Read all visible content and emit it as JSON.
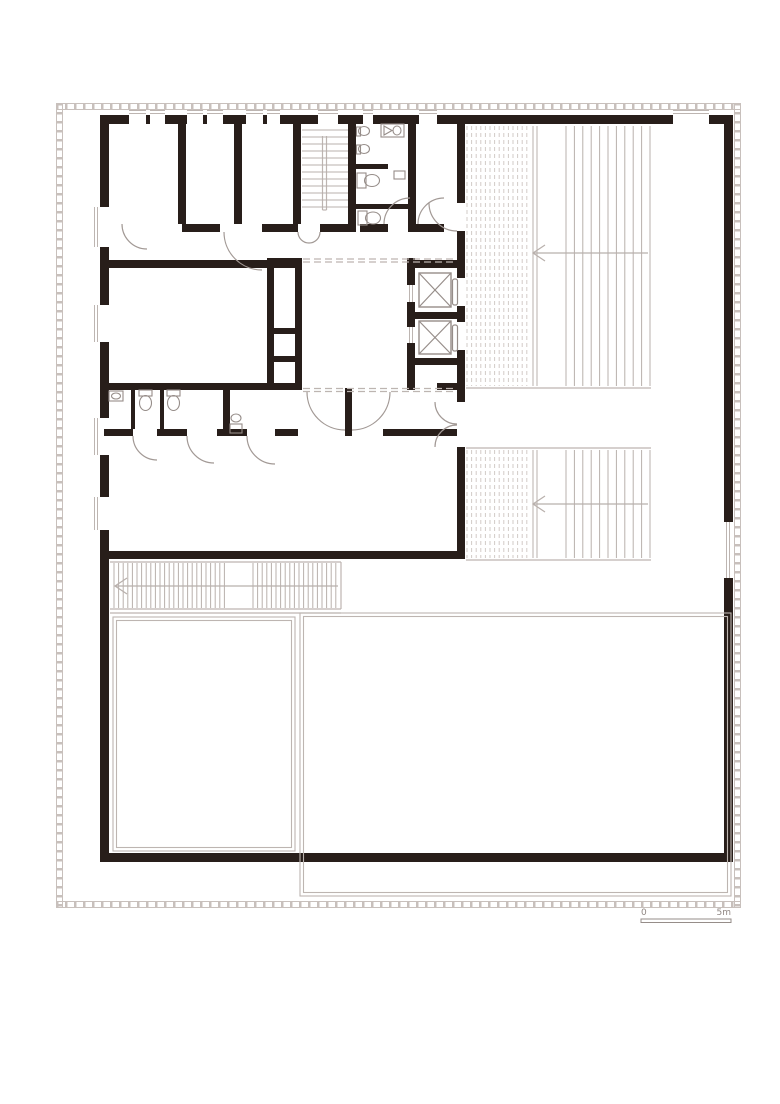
{
  "document": {
    "kind": "architectural floor plan, single storey, black walls on white"
  },
  "scale_bar": {
    "start_label": "0",
    "end_label": "5m"
  },
  "colors": {
    "wall": "#281e1a",
    "line_light": "#bdb5b1",
    "line_mid": "#968d89",
    "door": "#a29995",
    "hatch_dash": "#d2cbc7",
    "hatch_line": "#b8b0ac",
    "frame": "#c8c0bc",
    "label": "#8f8682",
    "background": "#ffffff"
  },
  "plan": {
    "walls": [
      [
        100,
        115,
        29,
        9
      ],
      [
        146,
        115,
        4,
        9
      ],
      [
        165,
        115,
        22,
        9
      ],
      [
        203,
        115,
        4,
        9
      ],
      [
        223,
        115,
        23,
        9
      ],
      [
        263,
        115,
        4,
        9
      ],
      [
        280,
        115,
        38,
        9
      ],
      [
        338,
        115,
        25,
        9
      ],
      [
        373,
        115,
        46,
        9
      ],
      [
        437,
        115,
        236,
        9
      ],
      [
        709,
        115,
        24,
        9
      ],
      [
        100,
        115,
        9,
        92
      ],
      [
        100,
        247,
        9,
        58
      ],
      [
        100,
        342,
        9,
        76
      ],
      [
        100,
        455,
        9,
        42
      ],
      [
        100,
        530,
        9,
        332
      ],
      [
        724,
        115,
        9,
        407
      ],
      [
        724,
        578,
        9,
        284
      ],
      [
        100,
        853,
        633,
        9
      ],
      [
        178,
        124,
        8,
        100
      ],
      [
        234,
        124,
        8,
        100
      ],
      [
        293,
        124,
        8,
        100
      ],
      [
        348,
        124,
        8,
        108
      ],
      [
        408,
        124,
        8,
        108
      ],
      [
        182,
        224,
        38,
        8
      ],
      [
        262,
        224,
        36,
        8
      ],
      [
        320,
        224,
        32,
        8
      ],
      [
        360,
        224,
        28,
        8
      ],
      [
        412,
        224,
        32,
        8
      ],
      [
        109,
        260,
        193,
        8
      ],
      [
        267,
        258,
        7,
        132
      ],
      [
        295,
        258,
        7,
        132
      ],
      [
        274,
        258,
        21,
        7
      ],
      [
        274,
        328,
        21,
        6
      ],
      [
        274,
        356,
        21,
        6
      ],
      [
        274,
        384,
        21,
        6
      ],
      [
        407,
        258,
        8,
        27
      ],
      [
        407,
        302,
        8,
        25
      ],
      [
        407,
        343,
        8,
        47
      ],
      [
        407,
        260,
        58,
        8
      ],
      [
        407,
        312,
        58,
        7
      ],
      [
        407,
        358,
        58,
        7
      ],
      [
        437,
        383,
        28,
        7
      ],
      [
        457,
        124,
        8,
        79
      ],
      [
        457,
        231,
        8,
        47
      ],
      [
        457,
        306,
        8,
        16
      ],
      [
        457,
        350,
        8,
        52
      ],
      [
        457,
        447,
        8,
        106
      ],
      [
        356,
        164,
        32,
        5
      ],
      [
        356,
        204,
        52,
        5
      ],
      [
        104,
        383,
        191,
        7
      ],
      [
        131,
        390,
        4,
        39
      ],
      [
        160,
        390,
        4,
        39
      ],
      [
        223,
        390,
        7,
        39
      ],
      [
        104,
        429,
        29,
        7
      ],
      [
        157,
        429,
        30,
        7
      ],
      [
        217,
        429,
        30,
        7
      ],
      [
        275,
        429,
        23,
        7
      ],
      [
        383,
        429,
        74,
        7
      ],
      [
        345,
        388,
        7,
        48
      ],
      [
        100,
        551,
        365,
        8
      ]
    ],
    "lines": [
      [
        466,
        388,
        651,
        388
      ],
      [
        466,
        448,
        651,
        448
      ],
      [
        466,
        560,
        651,
        560
      ],
      [
        110,
        562,
        341,
        562
      ],
      [
        110,
        609,
        341,
        609
      ],
      [
        341,
        562,
        341,
        609
      ],
      [
        110,
        613,
        341,
        613
      ],
      [
        322.5,
        136,
        322.5,
        210
      ],
      [
        326.5,
        136,
        326.5,
        210
      ],
      [
        322.5,
        210,
        326.5,
        210
      ]
    ],
    "glazing": [
      {
        "o": "h",
        "pos": 112,
        "from": 129,
        "to": 146
      },
      {
        "o": "h",
        "pos": 112,
        "from": 150,
        "to": 165
      },
      {
        "o": "h",
        "pos": 112,
        "from": 187,
        "to": 203
      },
      {
        "o": "h",
        "pos": 112,
        "from": 207,
        "to": 223
      },
      {
        "o": "h",
        "pos": 112,
        "from": 246,
        "to": 263
      },
      {
        "o": "h",
        "pos": 112,
        "from": 267,
        "to": 280
      },
      {
        "o": "h",
        "pos": 112,
        "from": 318,
        "to": 338
      },
      {
        "o": "h",
        "pos": 112,
        "from": 363,
        "to": 373
      },
      {
        "o": "h",
        "pos": 112,
        "from": 419,
        "to": 437
      },
      {
        "o": "h",
        "pos": 112,
        "from": 673,
        "to": 709
      },
      {
        "o": "v",
        "pos": 96,
        "from": 207,
        "to": 247
      },
      {
        "o": "v",
        "pos": 96,
        "from": 305,
        "to": 342
      },
      {
        "o": "v",
        "pos": 96,
        "from": 418,
        "to": 455
      },
      {
        "o": "v",
        "pos": 96,
        "from": 497,
        "to": 530
      },
      {
        "o": "v",
        "pos": 728,
        "from": 522,
        "to": 578
      },
      {
        "o": "v",
        "pos": 411,
        "from": 285,
        "to": 302
      },
      {
        "o": "v",
        "pos": 411,
        "from": 327,
        "to": 343
      }
    ],
    "dashed_overhead": [
      [
        303,
        259,
        457,
        259
      ],
      [
        303,
        262,
        457,
        262
      ],
      [
        303,
        388.5,
        457,
        388.5
      ],
      [
        303,
        391.5,
        457,
        391.5
      ]
    ],
    "hatch": [
      {
        "o": "v",
        "from": 467,
        "to": 527,
        "step": 4.6,
        "a1": 126,
        "a2": 386,
        "dash": true
      },
      {
        "o": "v",
        "from": 533,
        "to": 537,
        "step": 4,
        "a1": 126,
        "a2": 386,
        "dash": false
      },
      {
        "o": "v",
        "from": 566,
        "to": 650,
        "step": 8.4,
        "a1": 126,
        "a2": 386,
        "dash": false
      },
      {
        "o": "v",
        "from": 467,
        "to": 527,
        "step": 4.6,
        "a1": 450,
        "a2": 558,
        "dash": true
      },
      {
        "o": "v",
        "from": 533,
        "to": 537,
        "step": 4,
        "a1": 450,
        "a2": 558,
        "dash": false
      },
      {
        "o": "v",
        "from": 566,
        "to": 650,
        "step": 8.4,
        "a1": 450,
        "a2": 558,
        "dash": false
      },
      {
        "o": "v",
        "from": 114,
        "to": 228,
        "step": 4.6,
        "a1": 563,
        "a2": 608,
        "dash": false
      },
      {
        "o": "v",
        "from": 253,
        "to": 337,
        "step": 4.6,
        "a1": 563,
        "a2": 608,
        "dash": false
      },
      {
        "o": "h",
        "from": 130,
        "to": 207,
        "step": 7,
        "a1": 302,
        "a2": 348,
        "dash": false
      }
    ],
    "arrows": [
      {
        "line": [
          648,
          253,
          533,
          253
        ],
        "head": "545,245 533,253 545,261"
      },
      {
        "line": [
          648,
          504,
          533,
          504
        ],
        "head": "545,496 533,504 545,512"
      },
      {
        "line": [
          338,
          586,
          115,
          586
        ],
        "head": "127,578 115,586 127,594"
      }
    ],
    "elevators": [
      {
        "box": [
          419,
          273,
          32,
          34
        ],
        "door": [
          452.5,
          279,
          5,
          26
        ]
      },
      {
        "box": [
          419,
          321,
          32,
          33
        ],
        "door": [
          452.5,
          325,
          5,
          26
        ]
      }
    ],
    "doors": [
      "M 224 232 A 38 38 0 0 0 262 270",
      "M 298 232 A 11 11 0 0 0 309 243",
      "M 320 232 A 11 11 0 0 1 309 243",
      "M 122 224 A 25 25 0 0 0 147 249",
      "M 384 224 A 26 26 0 0 1 410 198",
      "M 444 198 A 26 26 0 0 0 418 224",
      "M 429 203 A 28 28 0 0 0 457 231",
      "M 133 436 A 24 24 0 0 0 157 460",
      "M 187 436 A 27 27 0 0 0 214 463",
      "M 247 436 A 28 28 0 0 0 275 464",
      "M 307 392 A 38 38 0 0 0 345 430",
      "M 390 392 A 38 38 0 0 1 352 430",
      "M 435 402 A 22 22 0 0 0 457 424",
      "M 435 447 A 22 22 0 0 1 457 425"
    ],
    "fixtures": [
      {
        "t": "ell",
        "cx": 364,
        "cy": 131,
        "rx": 5.5,
        "ry": 4.5
      },
      {
        "t": "rect",
        "x": 356.5,
        "y": 127,
        "w": 4,
        "h": 9
      },
      {
        "t": "ell",
        "cx": 364,
        "cy": 149,
        "rx": 5.5,
        "ry": 4.5
      },
      {
        "t": "rect",
        "x": 356.5,
        "y": 145,
        "w": 4,
        "h": 9
      },
      {
        "t": "rect",
        "x": 381,
        "y": 124,
        "w": 23,
        "h": 13
      },
      {
        "t": "path",
        "d": "M 384 126 L 392 130.5 L 384 135 Z"
      },
      {
        "t": "ell",
        "cx": 397,
        "cy": 130.5,
        "rx": 4,
        "ry": 4.5
      },
      {
        "t": "rect",
        "x": 357,
        "y": 173,
        "w": 9,
        "h": 15
      },
      {
        "t": "ell",
        "cx": 372,
        "cy": 180.5,
        "rx": 7.5,
        "ry": 6
      },
      {
        "t": "rect",
        "x": 394,
        "y": 171,
        "w": 11,
        "h": 8
      },
      {
        "t": "rect",
        "x": 358,
        "y": 211,
        "w": 9,
        "h": 14
      },
      {
        "t": "ell",
        "cx": 373,
        "cy": 218,
        "rx": 7.5,
        "ry": 6
      },
      {
        "t": "rect",
        "x": 109,
        "y": 391,
        "w": 14,
        "h": 10
      },
      {
        "t": "ell",
        "cx": 116,
        "cy": 396,
        "rx": 4.5,
        "ry": 3
      },
      {
        "t": "rect",
        "x": 139,
        "y": 390,
        "w": 13,
        "h": 6
      },
      {
        "t": "ell",
        "cx": 145.5,
        "cy": 403,
        "rx": 6,
        "ry": 7.5
      },
      {
        "t": "rect",
        "x": 167,
        "y": 390,
        "w": 13,
        "h": 6
      },
      {
        "t": "ell",
        "cx": 173.5,
        "cy": 403,
        "rx": 6,
        "ry": 7.5
      },
      {
        "t": "rect",
        "x": 230,
        "y": 424,
        "w": 12,
        "h": 9
      },
      {
        "t": "ell",
        "cx": 236,
        "cy": 418,
        "rx": 5,
        "ry": 4
      }
    ],
    "gray_rects": [
      [
        113,
        617,
        182,
        234
      ],
      [
        116.5,
        620.5,
        175,
        227
      ],
      [
        300,
        613,
        431,
        283
      ],
      [
        303.5,
        616.5,
        424,
        276
      ]
    ],
    "frame_sides": [
      {
        "o": "h",
        "from": 56,
        "to": 741,
        "l1": 103.5,
        "l2": 109.5,
        "c": 106.5
      },
      {
        "o": "h",
        "from": 56,
        "to": 741,
        "l1": 901.5,
        "l2": 907.5,
        "c": 904.5
      },
      {
        "o": "v",
        "from": 103,
        "to": 908,
        "l1": 56.5,
        "l2": 62.5,
        "c": 59.5
      },
      {
        "o": "v",
        "from": 103,
        "to": 908,
        "l1": 734.5,
        "l2": 740.5,
        "c": 737.5
      }
    ]
  }
}
